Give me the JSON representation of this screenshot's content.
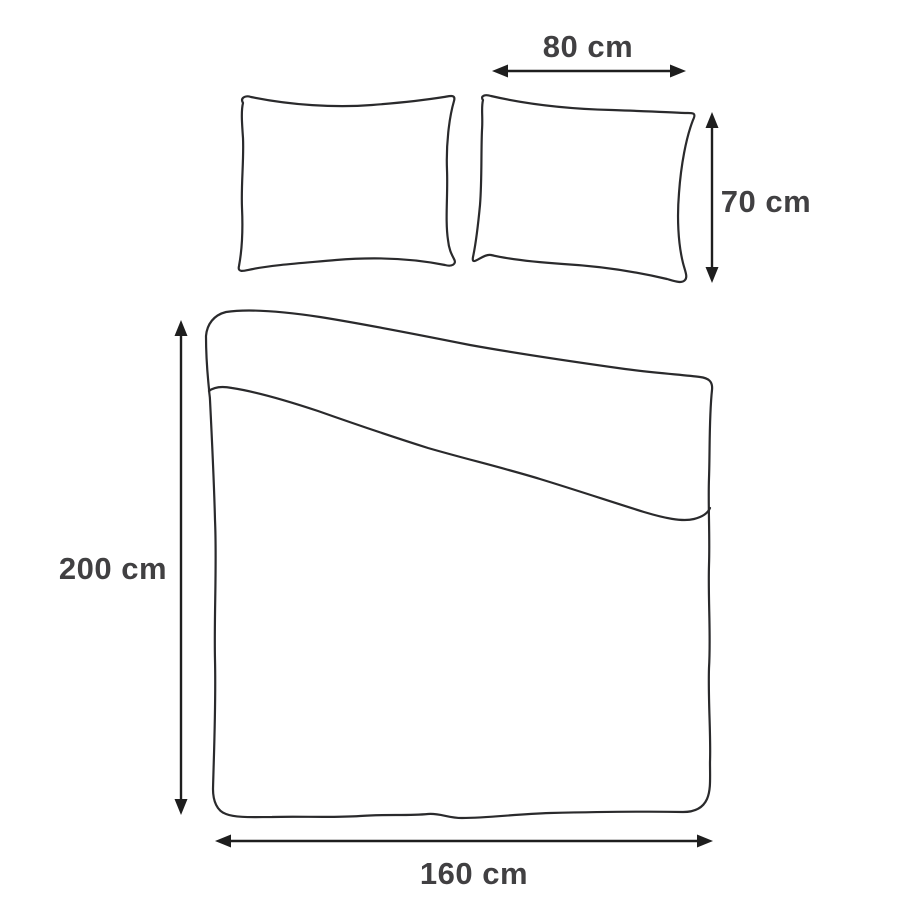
{
  "diagram": {
    "shapes": [
      "pillow-left",
      "pillow-right",
      "duvet-with-folded-top"
    ],
    "labels": {
      "pillow_width": "80 cm",
      "pillow_height": "70 cm",
      "duvet_length": "200 cm",
      "duvet_width": "160 cm"
    },
    "colors": {
      "outline": "#2a2a2c",
      "arrow": "#1e1e1e",
      "label_text": "#414042",
      "background": "#ffffff"
    }
  }
}
